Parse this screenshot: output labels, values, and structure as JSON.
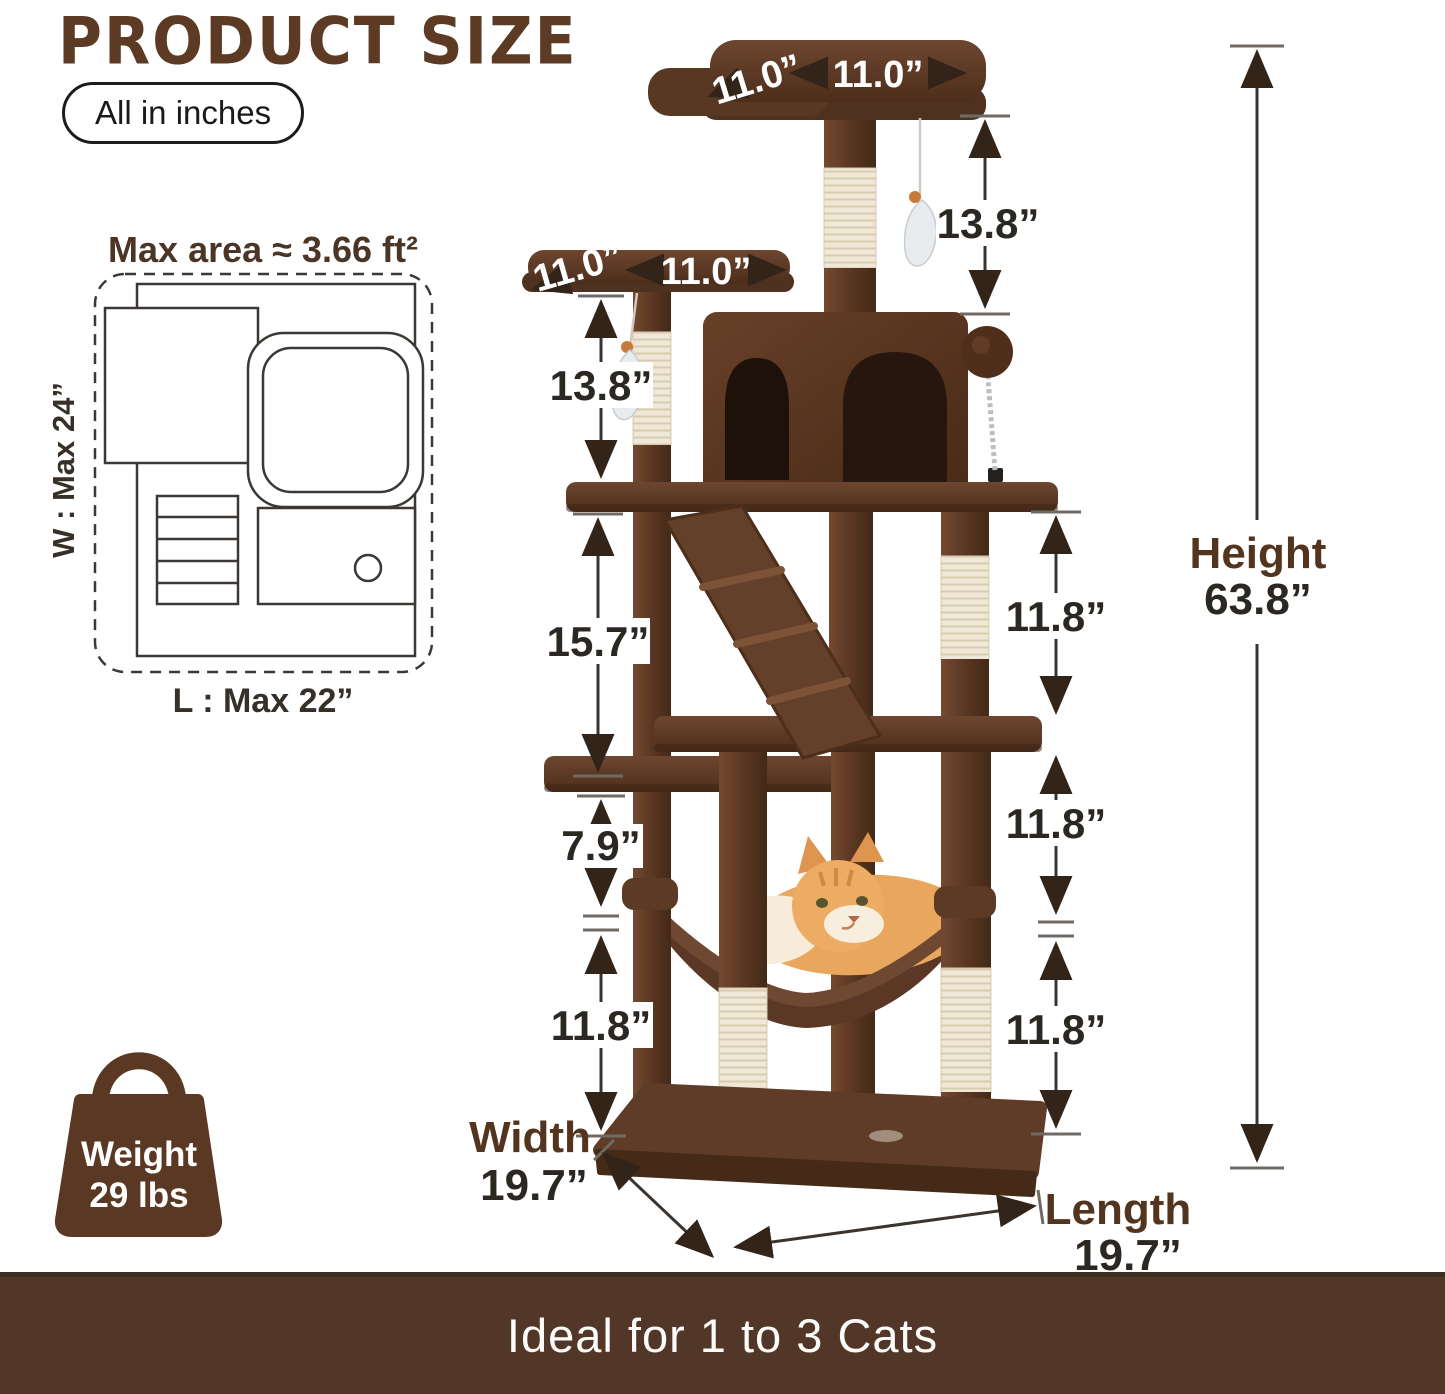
{
  "header": {
    "title": "PRODUCT SIZE",
    "unit_note": "All in inches"
  },
  "floor_plan": {
    "max_area_label": "Max area ≈ 3.66 ft²",
    "width_label": "W : Max 24”",
    "length_label": "L : Max 22”"
  },
  "dimensions": {
    "top_perch_depth": "11.0”",
    "top_perch_width": "11.0”",
    "top_perch_to_condo": "13.8”",
    "upper_perch_depth": "11.0”",
    "upper_perch_width": "11.0”",
    "upper_perch_to_platform": "13.8”",
    "platform_to_lower_platform": "15.7”",
    "right_upper_post": "11.8”",
    "platform_to_hammock": "7.9”",
    "left_lower_post": "11.8”",
    "right_middle_post": "11.8”",
    "right_lower_post": "11.8”",
    "height_label": "Height",
    "height_value": "63.8”",
    "width_label": "Width",
    "width_value": "19.7”",
    "length_label": "Length",
    "length_value": "19.7”"
  },
  "weight_badge": {
    "label": "Weight",
    "value": "29 lbs"
  },
  "footer": {
    "text": "Ideal for 1 to 3 Cats"
  },
  "colors": {
    "accent_brown": "#5c3a23",
    "banner_brown": "#523729",
    "plush_brown": "#5d3b26",
    "sisal_cream": "#efe8d8",
    "label_dark": "#2b2723"
  }
}
